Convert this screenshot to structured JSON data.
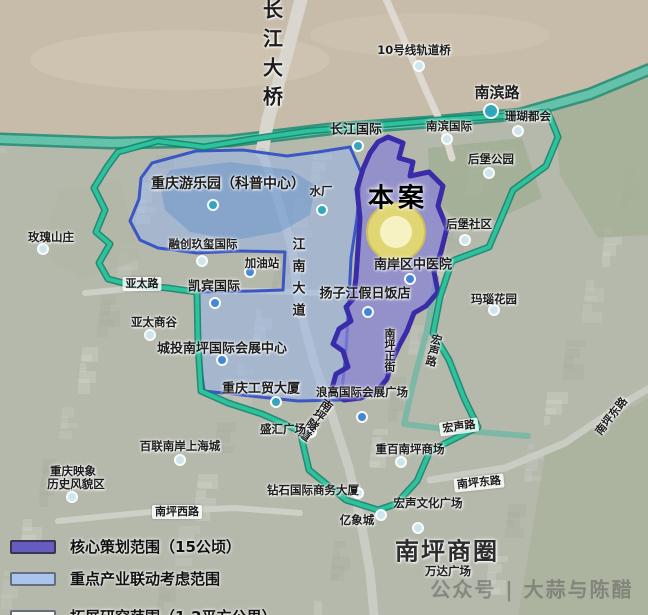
{
  "watermark": "公众号 | 大蒜与陈醋",
  "legend": {
    "items": [
      {
        "label": "核心策划范围（15公顷）",
        "fill": "#665cc0",
        "border": "#3a3550"
      },
      {
        "label": "重点产业联动考虑范围",
        "fill": "#a9c4ee",
        "border": "#666e7a"
      },
      {
        "label": "拓展研究范围（1.2平方公里）",
        "fill": "#ffffff",
        "border": "#666e7a",
        "line": "#3ecb9e"
      }
    ]
  },
  "map": {
    "colors": {
      "city": "#b5b9ac",
      "river": "#c7bcaa",
      "study": "#2cc39c",
      "studyCasing": "#0f7f68",
      "linkageFill": "rgba(150,180,238,0.5)",
      "linkageStroke": "#3a57c4",
      "coreFill": "rgba(135,128,214,0.72)",
      "coreStroke": "#3a2ca8",
      "site": "#e8dc6d",
      "siteInner": "#f7f2c2"
    },
    "river": [
      [
        0,
        0
      ],
      [
        648,
        0
      ],
      [
        648,
        62
      ],
      [
        590,
        88
      ],
      [
        520,
        108
      ],
      [
        430,
        116
      ],
      [
        330,
        124
      ],
      [
        230,
        136
      ],
      [
        110,
        138
      ],
      [
        0,
        134
      ]
    ],
    "roads": [
      {
        "k": "riverband",
        "w": 13,
        "pts": [
          [
            0,
            139
          ],
          [
            110,
            143
          ],
          [
            230,
            141
          ],
          [
            330,
            129
          ],
          [
            430,
            122
          ],
          [
            520,
            114
          ],
          [
            590,
            94
          ],
          [
            648,
            70
          ]
        ]
      },
      {
        "k": "bridge",
        "w": 13,
        "pts": [
          [
            303,
            -8
          ],
          [
            285,
            60
          ],
          [
            268,
            120
          ],
          [
            262,
            152
          ]
        ]
      },
      {
        "k": "major",
        "w": 9,
        "pts": [
          [
            262,
            152
          ],
          [
            278,
            200
          ],
          [
            292,
            248
          ],
          [
            299,
            305
          ],
          [
            314,
            362
          ],
          [
            331,
            412
          ],
          [
            349,
            468
          ],
          [
            361,
            522
          ],
          [
            370,
            572
          ],
          [
            374,
            615
          ]
        ]
      },
      {
        "k": "rail",
        "w": 7,
        "pts": [
          [
            383,
            -8
          ],
          [
            405,
            42
          ],
          [
            425,
            88
          ],
          [
            443,
            128
          ],
          [
            452,
            158
          ]
        ]
      },
      {
        "k": "major",
        "w": 7,
        "pts": [
          [
            430,
            480
          ],
          [
            505,
            468
          ],
          [
            565,
            443
          ],
          [
            624,
            403
          ],
          [
            648,
            389
          ]
        ]
      },
      {
        "k": "minor",
        "w": 6,
        "pts": [
          [
            58,
            521
          ],
          [
            150,
            512
          ],
          [
            235,
            508
          ],
          [
            300,
            513
          ]
        ]
      },
      {
        "k": "teal",
        "w": 6,
        "pts": [
          [
            436,
            278
          ],
          [
            427,
            330
          ],
          [
            412,
            388
          ],
          [
            404,
            424
          ],
          [
            452,
            430
          ],
          [
            528,
            436
          ]
        ]
      },
      {
        "k": "minor",
        "w": 6,
        "pts": [
          [
            85,
            293
          ],
          [
            150,
            287
          ],
          [
            220,
            290
          ],
          [
            290,
            292
          ],
          [
            352,
            294
          ]
        ]
      }
    ],
    "lake": [
      [
        170,
        170
      ],
      [
        230,
        162
      ],
      [
        290,
        170
      ],
      [
        315,
        185
      ],
      [
        310,
        215
      ],
      [
        280,
        232
      ],
      [
        235,
        240
      ],
      [
        190,
        232
      ],
      [
        165,
        210
      ],
      [
        160,
        185
      ]
    ],
    "regions": {
      "study": {
        "name": "拓展研究范围（1.2平方公里）",
        "points": [
          [
            118,
            152
          ],
          [
            158,
            141
          ],
          [
            204,
            147
          ],
          [
            252,
            139
          ],
          [
            308,
            131
          ],
          [
            368,
            126
          ],
          [
            438,
            120
          ],
          [
            504,
            116
          ],
          [
            548,
            112
          ],
          [
            558,
            137
          ],
          [
            546,
            166
          ],
          [
            513,
            190
          ],
          [
            500,
            221
          ],
          [
            489,
            247
          ],
          [
            452,
            261
          ],
          [
            440,
            297
          ],
          [
            433,
            333
          ],
          [
            449,
            360
          ],
          [
            464,
            398
          ],
          [
            478,
            427
          ],
          [
            430,
            451
          ],
          [
            417,
            481
          ],
          [
            396,
            504
          ],
          [
            378,
            510
          ],
          [
            346,
            500
          ],
          [
            309,
            470
          ],
          [
            300,
            431
          ],
          [
            262,
            414
          ],
          [
            228,
            403
          ],
          [
            201,
            391
          ],
          [
            198,
            344
          ],
          [
            197,
            292
          ],
          [
            168,
            288
          ],
          [
            131,
            285
          ],
          [
            108,
            279
          ],
          [
            99,
            263
          ],
          [
            110,
            244
          ],
          [
            96,
            232
          ],
          [
            105,
            210
          ],
          [
            94,
            188
          ],
          [
            107,
            167
          ]
        ]
      },
      "linkage": {
        "name": "重点产业联动考虑范围",
        "points": [
          [
            152,
            163
          ],
          [
            196,
            151
          ],
          [
            243,
            150
          ],
          [
            287,
            156
          ],
          [
            318,
            152
          ],
          [
            350,
            147
          ],
          [
            361,
            172
          ],
          [
            357,
            218
          ],
          [
            351,
            258
          ],
          [
            349,
            300
          ],
          [
            346,
            352
          ],
          [
            341,
            400
          ],
          [
            298,
            401
          ],
          [
            251,
            396
          ],
          [
            204,
            391
          ],
          [
            198,
            344
          ],
          [
            197,
            292
          ],
          [
            254,
            291
          ],
          [
            283,
            290
          ],
          [
            285,
            252
          ],
          [
            240,
            251
          ],
          [
            197,
            253
          ],
          [
            158,
            248
          ],
          [
            140,
            240
          ],
          [
            130,
            221
          ],
          [
            139,
            199
          ],
          [
            141,
            178
          ]
        ]
      },
      "core": {
        "name": "核心策划范围（15公顷）",
        "points": [
          [
            388,
            137
          ],
          [
            403,
            143
          ],
          [
            399,
            158
          ],
          [
            413,
            162
          ],
          [
            410,
            176
          ],
          [
            429,
            172
          ],
          [
            443,
            186
          ],
          [
            438,
            206
          ],
          [
            447,
            228
          ],
          [
            441,
            252
          ],
          [
            434,
            272
          ],
          [
            438,
            292
          ],
          [
            426,
            306
          ],
          [
            414,
            313
          ],
          [
            407,
            331
          ],
          [
            399,
            346
          ],
          [
            392,
            361
          ],
          [
            387,
            379
          ],
          [
            377,
            391
          ],
          [
            361,
            398
          ],
          [
            344,
            400
          ],
          [
            331,
            392
          ],
          [
            336,
            374
          ],
          [
            348,
            367
          ],
          [
            343,
            351
          ],
          [
            333,
            344
          ],
          [
            339,
            329
          ],
          [
            351,
            321
          ],
          [
            346,
            307
          ],
          [
            353,
            299
          ],
          [
            356,
            278
          ],
          [
            358,
            248
          ],
          [
            360,
            218
          ],
          [
            357,
            189
          ],
          [
            363,
            169
          ],
          [
            370,
            153
          ],
          [
            378,
            142
          ]
        ]
      }
    },
    "site": {
      "x": 396,
      "y": 232,
      "r": 29,
      "label": "本案"
    },
    "labels": [
      {
        "t": "长江大桥",
        "x": 272,
        "y": 57,
        "k": "road",
        "v": 1,
        "fs": 20,
        "ls": 9
      },
      {
        "t": "10号线轨道桥",
        "x": 414,
        "y": 50,
        "k": "sm"
      },
      {
        "t": "南滨路",
        "x": 497,
        "y": 92,
        "k": "road",
        "fs": 15
      },
      {
        "t": "长江国际",
        "x": 356,
        "y": 128,
        "k": "road",
        "fs": 13
      },
      {
        "t": "南滨国际",
        "x": 449,
        "y": 126,
        "k": "sm"
      },
      {
        "t": "珊瑚都会",
        "x": 528,
        "y": 116,
        "k": "sm"
      },
      {
        "t": "后堡公园",
        "x": 491,
        "y": 159,
        "k": "sm"
      },
      {
        "t": "重庆游乐园（科普中心）",
        "x": 228,
        "y": 183,
        "k": "place",
        "fs": 14
      },
      {
        "t": "水厂",
        "x": 321,
        "y": 191,
        "k": "sm"
      },
      {
        "t": "本案",
        "x": 398,
        "y": 196,
        "k": "project"
      },
      {
        "t": "玫瑰山庄",
        "x": 51,
        "y": 237,
        "k": "sm"
      },
      {
        "t": "后堡社区",
        "x": 469,
        "y": 224,
        "k": "sm"
      },
      {
        "t": "融创玖玺国际",
        "x": 203,
        "y": 244,
        "k": "sm"
      },
      {
        "t": "加油站",
        "x": 262,
        "y": 263,
        "k": "sm"
      },
      {
        "t": "南岸区中医院",
        "x": 413,
        "y": 263,
        "k": "place",
        "fs": 13
      },
      {
        "t": "亚太路",
        "x": 142,
        "y": 284,
        "k": "chip"
      },
      {
        "t": "凯宾国际",
        "x": 214,
        "y": 285,
        "k": "place",
        "fs": 13
      },
      {
        "t": "江南大道",
        "x": 297,
        "y": 281,
        "k": "road",
        "v": 1,
        "fs": 13,
        "ls": 9
      },
      {
        "t": "扬子江假日饭店",
        "x": 365,
        "y": 292,
        "k": "place",
        "fs": 13
      },
      {
        "t": "玛瑙花园",
        "x": 494,
        "y": 299,
        "k": "sm"
      },
      {
        "t": "亚太商谷",
        "x": 154,
        "y": 322,
        "k": "sm"
      },
      {
        "t": "城投南坪国际会展中心",
        "x": 222,
        "y": 347,
        "k": "place",
        "fs": 13
      },
      {
        "t": "南坪正街",
        "x": 389,
        "y": 350,
        "k": "road",
        "v": 1,
        "fs": 11
      },
      {
        "t": "宏声路",
        "x": 433,
        "y": 350,
        "k": "road",
        "v": 1,
        "fs": 11,
        "r": 14
      },
      {
        "t": "重庆工贸大厦",
        "x": 261,
        "y": 387,
        "k": "place",
        "fs": 13
      },
      {
        "t": "浪高国际会展广场",
        "x": 362,
        "y": 392,
        "k": "sm"
      },
      {
        "t": "南坪隧道",
        "x": 316,
        "y": 420,
        "k": "road",
        "v": 1,
        "fs": 12,
        "r": 36
      },
      {
        "t": "盛汇广场",
        "x": 283,
        "y": 429,
        "k": "sm"
      },
      {
        "t": "宏声路",
        "x": 459,
        "y": 427,
        "k": "chip",
        "r": -8
      },
      {
        "t": "南坪东路",
        "x": 611,
        "y": 416,
        "k": "road",
        "fs": 11,
        "r": -52
      },
      {
        "t": "百联南岸上海城",
        "x": 180,
        "y": 446,
        "k": "sm"
      },
      {
        "t": "重百南坪商场",
        "x": 410,
        "y": 449,
        "k": "sm"
      },
      {
        "t": "重庆映象",
        "x": 73,
        "y": 471,
        "k": "sm"
      },
      {
        "t": "历史风貌区",
        "x": 76,
        "y": 484,
        "k": "sm"
      },
      {
        "t": "南坪东路",
        "x": 479,
        "y": 483,
        "k": "chip",
        "r": -6
      },
      {
        "t": "钻石国际商务大厦",
        "x": 313,
        "y": 490,
        "k": "sm"
      },
      {
        "t": "宏声文化广场",
        "x": 428,
        "y": 503,
        "k": "sm"
      },
      {
        "t": "南坪西路",
        "x": 177,
        "y": 512,
        "k": "chip"
      },
      {
        "t": "亿象城",
        "x": 357,
        "y": 520,
        "k": "sm"
      },
      {
        "t": "南坪商圈",
        "x": 447,
        "y": 549,
        "k": "big"
      },
      {
        "t": "万达广场",
        "x": 448,
        "y": 571,
        "k": "sm"
      }
    ],
    "markers": [
      {
        "x": 419,
        "y": 66,
        "c": "pale"
      },
      {
        "x": 491,
        "y": 111,
        "c": "teal",
        "r": 7
      },
      {
        "x": 518,
        "y": 131,
        "c": "pale"
      },
      {
        "x": 489,
        "y": 173,
        "c": "pale"
      },
      {
        "x": 43,
        "y": 249,
        "c": "pale"
      },
      {
        "x": 213,
        "y": 205,
        "c": "teal"
      },
      {
        "x": 358,
        "y": 146,
        "c": "teal"
      },
      {
        "x": 447,
        "y": 139,
        "c": "pale"
      },
      {
        "x": 465,
        "y": 240,
        "c": "pale"
      },
      {
        "x": 202,
        "y": 261,
        "c": "pale"
      },
      {
        "x": 250,
        "y": 272,
        "c": "blue"
      },
      {
        "x": 322,
        "y": 210,
        "c": "teal"
      },
      {
        "x": 410,
        "y": 279,
        "c": "blue"
      },
      {
        "x": 215,
        "y": 303,
        "c": "blue"
      },
      {
        "x": 150,
        "y": 335,
        "c": "pale"
      },
      {
        "x": 368,
        "y": 312,
        "c": "blue"
      },
      {
        "x": 222,
        "y": 360,
        "c": "blue"
      },
      {
        "x": 494,
        "y": 310,
        "c": "pale"
      },
      {
        "x": 276,
        "y": 402,
        "c": "teal"
      },
      {
        "x": 362,
        "y": 417,
        "c": "blue"
      },
      {
        "x": 311,
        "y": 432,
        "c": "pale"
      },
      {
        "x": 401,
        "y": 462,
        "c": "pale"
      },
      {
        "x": 358,
        "y": 493,
        "c": "pale"
      },
      {
        "x": 381,
        "y": 515,
        "c": "pale"
      },
      {
        "x": 418,
        "y": 528,
        "c": "pale"
      },
      {
        "x": 180,
        "y": 460,
        "c": "pale"
      },
      {
        "x": 72,
        "y": 497,
        "c": "pale"
      }
    ]
  }
}
